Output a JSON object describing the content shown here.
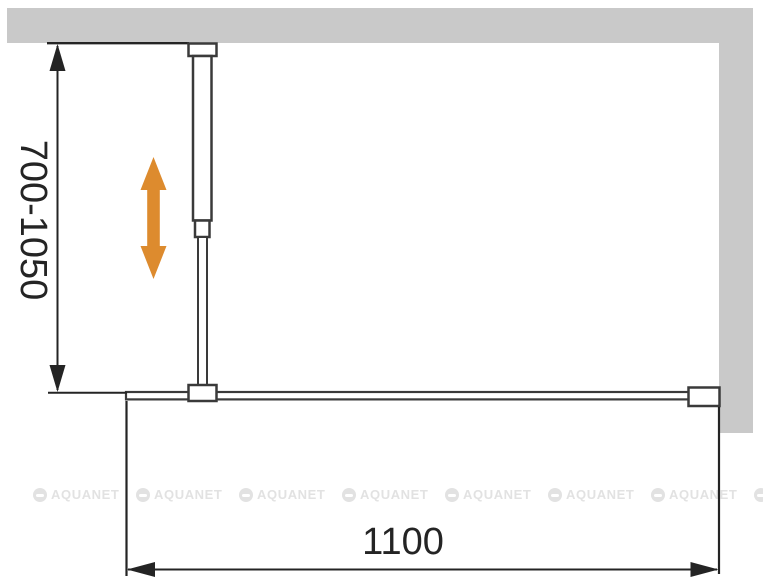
{
  "colors": {
    "wall": "#c9c9c9",
    "outline": "#3a3a3a",
    "dimension": "#242424",
    "accent": "#dd8b2e",
    "watermark": "#e2e2e2",
    "background": "#ffffff"
  },
  "labels": {
    "depth_range": "700-1050",
    "width": "1100"
  },
  "watermark": {
    "text": "AQUANET",
    "repeat": 8
  }
}
